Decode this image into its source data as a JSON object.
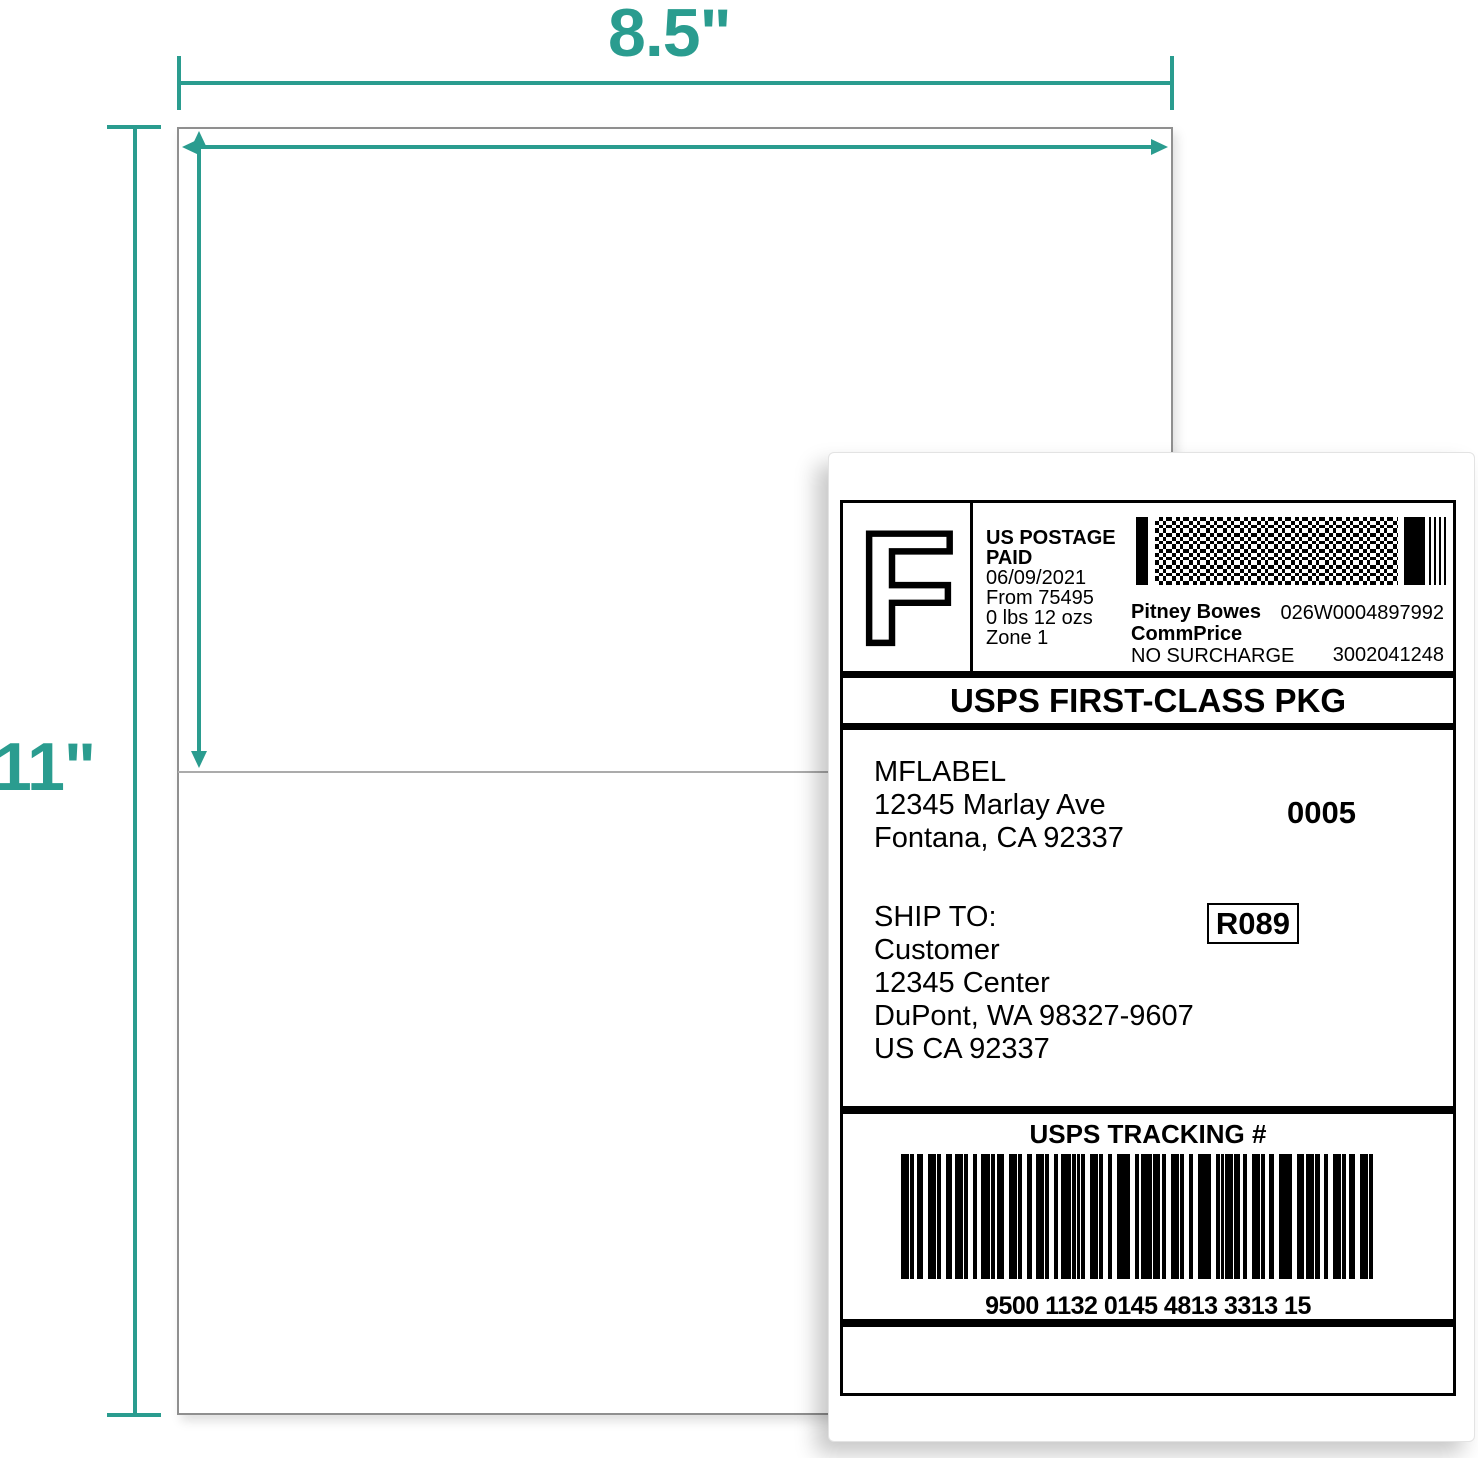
{
  "colors": {
    "accent_teal": "#2a9c8f",
    "sheet_border_gray": "#8f8f8f",
    "perforation_gray": "#ababab",
    "label_ink": "#000000"
  },
  "annotations": {
    "width_outer": "8.5\"",
    "width_inner": "8.5\"",
    "half_height": "5.5\"",
    "full_height": "11\""
  },
  "shipping_label": {
    "postage_block": {
      "indicia_letter": "F",
      "paid_line1": "US POSTAGE",
      "paid_line2": "PAID",
      "date": "06/09/2021",
      "origin": "From 75495",
      "weight": "0 lbs 12 ozs",
      "zone": "Zone 1",
      "vendor": "Pitney Bowes",
      "rate_type": "CommPrice",
      "surcharge": "NO SURCHARGE",
      "meter_id": "026W0004897992",
      "account_id": "3002041248"
    },
    "service_banner": "USPS FIRST-CLASS PKG",
    "return_address": {
      "name": "MFLABEL",
      "street": "12345 Marlay Ave",
      "city_state_zip": "Fontana, CA 92337"
    },
    "label_sequence": "0005",
    "ship_to_heading": "SHIP TO:",
    "destination": {
      "name": "Customer",
      "street": "12345 Center",
      "city_state_zip": "DuPont, WA 98327-9607",
      "country_line": "US CA 92337"
    },
    "routing_code": "R089",
    "tracking_heading": "USPS TRACKING #",
    "tracking_number": "9500 1132 0145 4813 3313 15"
  }
}
